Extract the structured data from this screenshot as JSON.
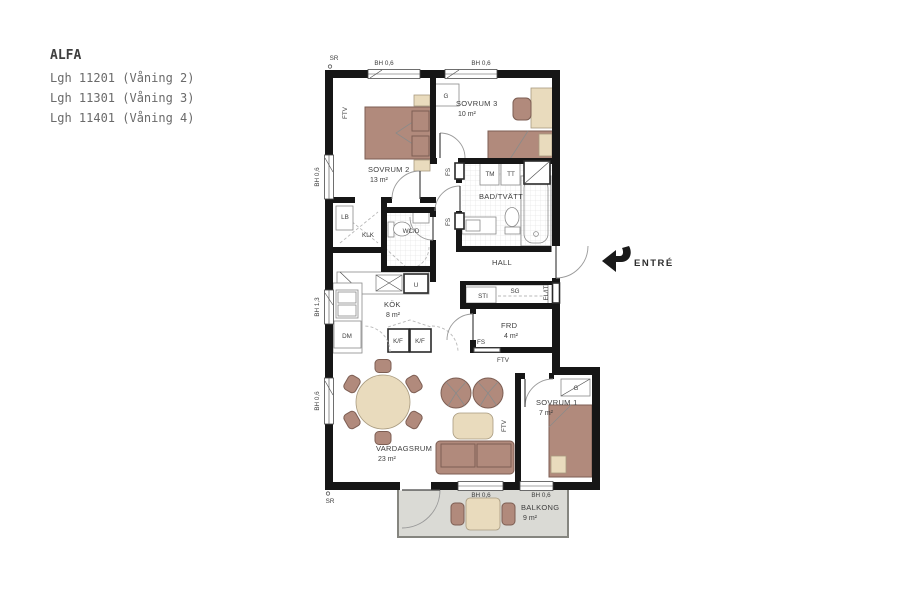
{
  "title_block": {
    "project": "ALFA",
    "units": [
      "Lgh 11201 (Våning 2)",
      "Lgh 11301 (Våning 3)",
      "Lgh 11401 (Våning 4)"
    ]
  },
  "entry": {
    "label": "ENTRÉ"
  },
  "rooms": {
    "sovrum2": {
      "name": "SOVRUM 2",
      "area": "13 m²"
    },
    "sovrum3": {
      "name": "SOVRUM 3",
      "area": "10 m²"
    },
    "bad_tvatt": {
      "name": "BAD/TVÄTT"
    },
    "hall": {
      "name": "HALL"
    },
    "kok": {
      "name": "KÖK",
      "area": "8 m²"
    },
    "frd": {
      "name": "FRD",
      "area": "4 m²"
    },
    "sovrum1": {
      "name": "SOVRUM 1",
      "area": "7 m²"
    },
    "vardagsrum": {
      "name": "VARDAGSRUM",
      "area": "23 m²"
    },
    "balkong": {
      "name": "BALKONG",
      "area": "9 m²"
    }
  },
  "fixtures": {
    "ftv": "FTV",
    "g": "G",
    "fs": "FS",
    "tm": "TM",
    "tt": "TT",
    "lb": "LB",
    "klk": "KLK",
    "wcd": "WC/D",
    "u": "U",
    "dm": "DM",
    "kf": "K/F",
    "sti": "STI",
    "sg": "SG",
    "elit": "EL/IT"
  },
  "marks": {
    "sr": "SR",
    "bh06": "BH 0,6",
    "bh13": "BH 1,3"
  },
  "colors": {
    "wall": "#161616",
    "furniture": "#b18a7c",
    "furniture_outline": "#7d5e53",
    "wood": "#e9dbbd",
    "balcony_floor": "#dadad5",
    "label": "#3d3d3d",
    "title": "#4d4d4d"
  }
}
